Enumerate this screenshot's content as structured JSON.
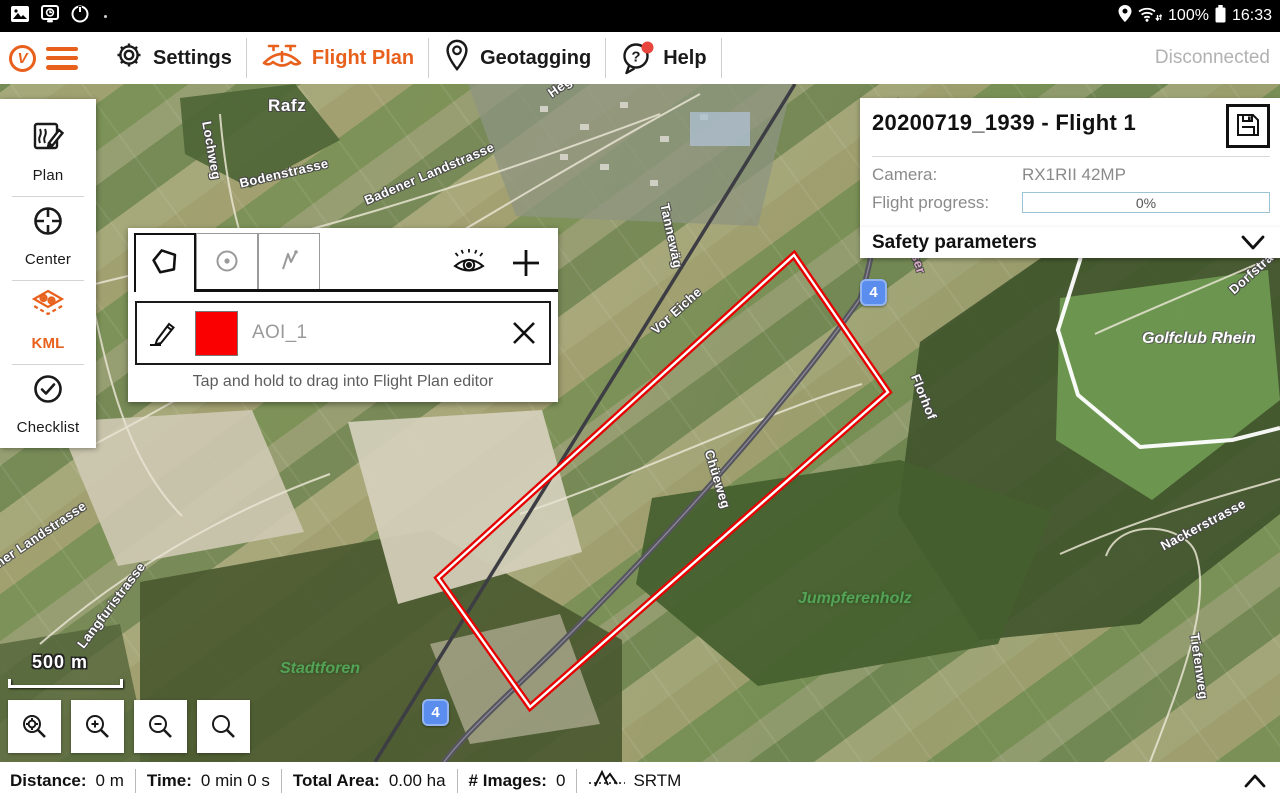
{
  "status_bar": {
    "time": "16:33",
    "battery": "100%"
  },
  "app_bar": {
    "accent_color": "#e8611c",
    "menu": [
      {
        "label": "Settings"
      },
      {
        "label": "Flight Plan",
        "active": true
      },
      {
        "label": "Geotagging"
      },
      {
        "label": "Help",
        "badge": true
      }
    ],
    "connection_status": "Disconnected"
  },
  "sidebar": {
    "items": [
      {
        "label": "Plan"
      },
      {
        "label": "Center"
      },
      {
        "label": "KML",
        "active": true
      },
      {
        "label": "Checklist"
      }
    ]
  },
  "aoi_panel": {
    "item": {
      "name": "AOI_1",
      "color": "#fa0000"
    },
    "hint": "Tap and hold to drag into Flight Plan editor"
  },
  "flight_card": {
    "title": "20200719_1939 - Flight 1",
    "camera_label": "Camera:",
    "camera_value": "RX1RII 42MP",
    "progress_label": "Flight progress:",
    "progress_value": "0%",
    "progress_percent": 0
  },
  "safety_bar": {
    "label": "Safety parameters"
  },
  "map": {
    "scale_label": "500 m",
    "shields": [
      {
        "label": "4"
      },
      {
        "label": "4"
      }
    ],
    "aoi_outline": {
      "points": "794,171 888,308 530,623 438,494",
      "stroke": "#e60000"
    },
    "labels": [
      {
        "text": "Rafz"
      },
      {
        "text": "Heg"
      },
      {
        "text": "Lochweg"
      },
      {
        "text": "Bodenstrasse"
      },
      {
        "text": "Badener Landstrasse"
      },
      {
        "text": "Tannewäg"
      },
      {
        "text": "Vor Eiche"
      },
      {
        "text": "Chüeweg"
      },
      {
        "text": "Jumpferenholz"
      },
      {
        "text": "Stadtforen"
      },
      {
        "text": "Golfclub Rhein"
      },
      {
        "text": "Dorfstra"
      },
      {
        "text": "Nackerstrasse"
      },
      {
        "text": "Tiefenweg"
      },
      {
        "text": "Bahnhofstrasse"
      },
      {
        "text": "ener Landstrasse"
      },
      {
        "text": "Langfuristrasse"
      },
      {
        "text": "Florhof"
      },
      {
        "text": "Schaffhauser"
      }
    ]
  },
  "bottom_bar": {
    "stats": [
      {
        "label": "Distance:",
        "value": "0 m"
      },
      {
        "label": "Time:",
        "value": "0 min 0 s"
      },
      {
        "label": "Total Area:",
        "value": "0.00 ha"
      },
      {
        "label": "# Images:",
        "value": "0"
      }
    ],
    "elevation_source": "SRTM"
  }
}
